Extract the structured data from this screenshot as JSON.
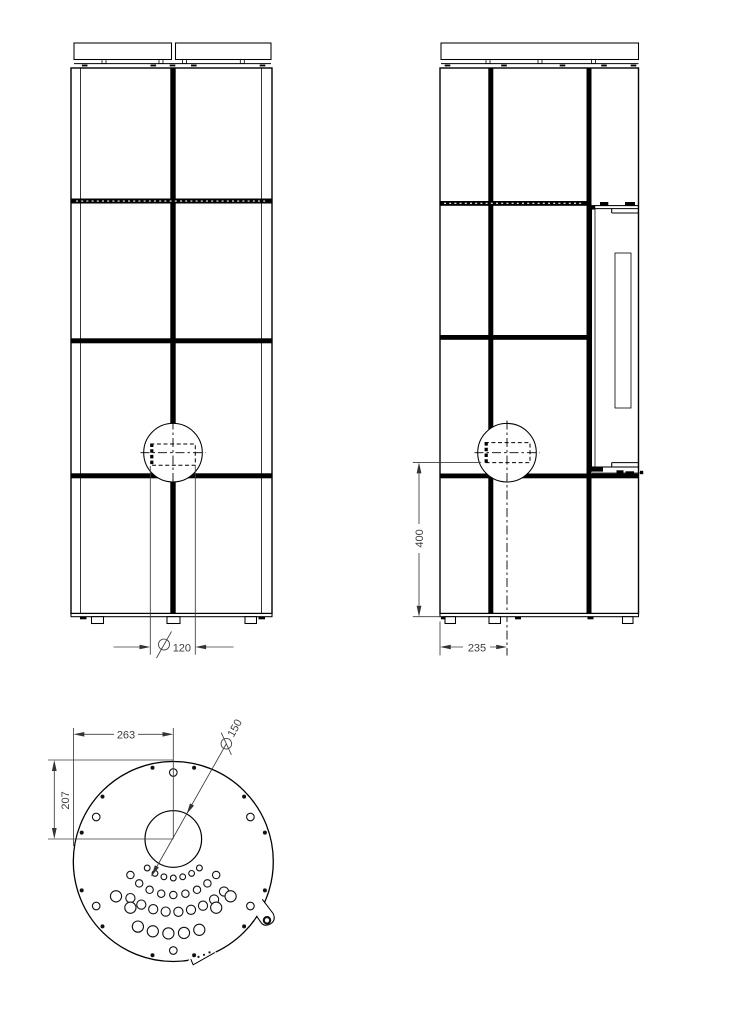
{
  "drawing": {
    "type": "stove-technical-drawing",
    "background": "#ffffff",
    "line_color": "#000000",
    "dim_color": "#3c3c3c"
  },
  "dimensions": {
    "flue_front_diameter": {
      "symbol": "Ø",
      "value": "120"
    },
    "flue_height_from_floor": {
      "value": "400"
    },
    "flue_center_offset": {
      "value": "235"
    },
    "plan_left_to_flue_center": {
      "value": "263"
    },
    "plan_top_to_flue_center": {
      "value": "207"
    },
    "flue_plan_diameter": {
      "symbol": "Ø",
      "value": "150"
    }
  },
  "plan_view": {
    "outer_circle": {
      "cx": 173.3,
      "cy": 861.5,
      "r": 100
    },
    "flue_circle": {
      "cx": 173.3,
      "cy": 839,
      "r": 28.3
    },
    "perimeter_open_holes": {
      "ring_radius": 89,
      "hole_radius": 3.8,
      "angles_deg": [
        -90,
        -30,
        30,
        90,
        150,
        -150
      ]
    },
    "perimeter_pin_holes": {
      "ring_radius": 96,
      "hole_radius": 2,
      "angles_deg": [
        -102.5,
        -77.5,
        -42.5,
        -17.5,
        17.5,
        42.5,
        77.5,
        102.5,
        137.5,
        162.5,
        -162.5,
        -137.5
      ]
    },
    "air_hole_arcs": [
      {
        "radius": 39,
        "hole_radius": 2.9,
        "start_deg": 48,
        "end_deg": 132,
        "count": 7
      },
      {
        "radius": 56,
        "hole_radius": 3.7,
        "start_deg": 40,
        "end_deg": 140,
        "count": 9
      },
      {
        "radius": 73,
        "hole_radius": 4.6,
        "start_deg": 46,
        "end_deg": 126,
        "count": 9
      },
      {
        "radius": 81,
        "hole_radius": 5.6,
        "angles_deg": [
          45,
          58,
          122,
          135
        ]
      },
      {
        "radius": 94.5,
        "hole_radius": 5.6,
        "start_deg": 74,
        "end_deg": 112,
        "count": 5
      }
    ],
    "notch_dots": [
      [
        198.5,
        956.9
      ],
      [
        204,
        954.8
      ],
      [
        209.5,
        952.4
      ]
    ]
  }
}
